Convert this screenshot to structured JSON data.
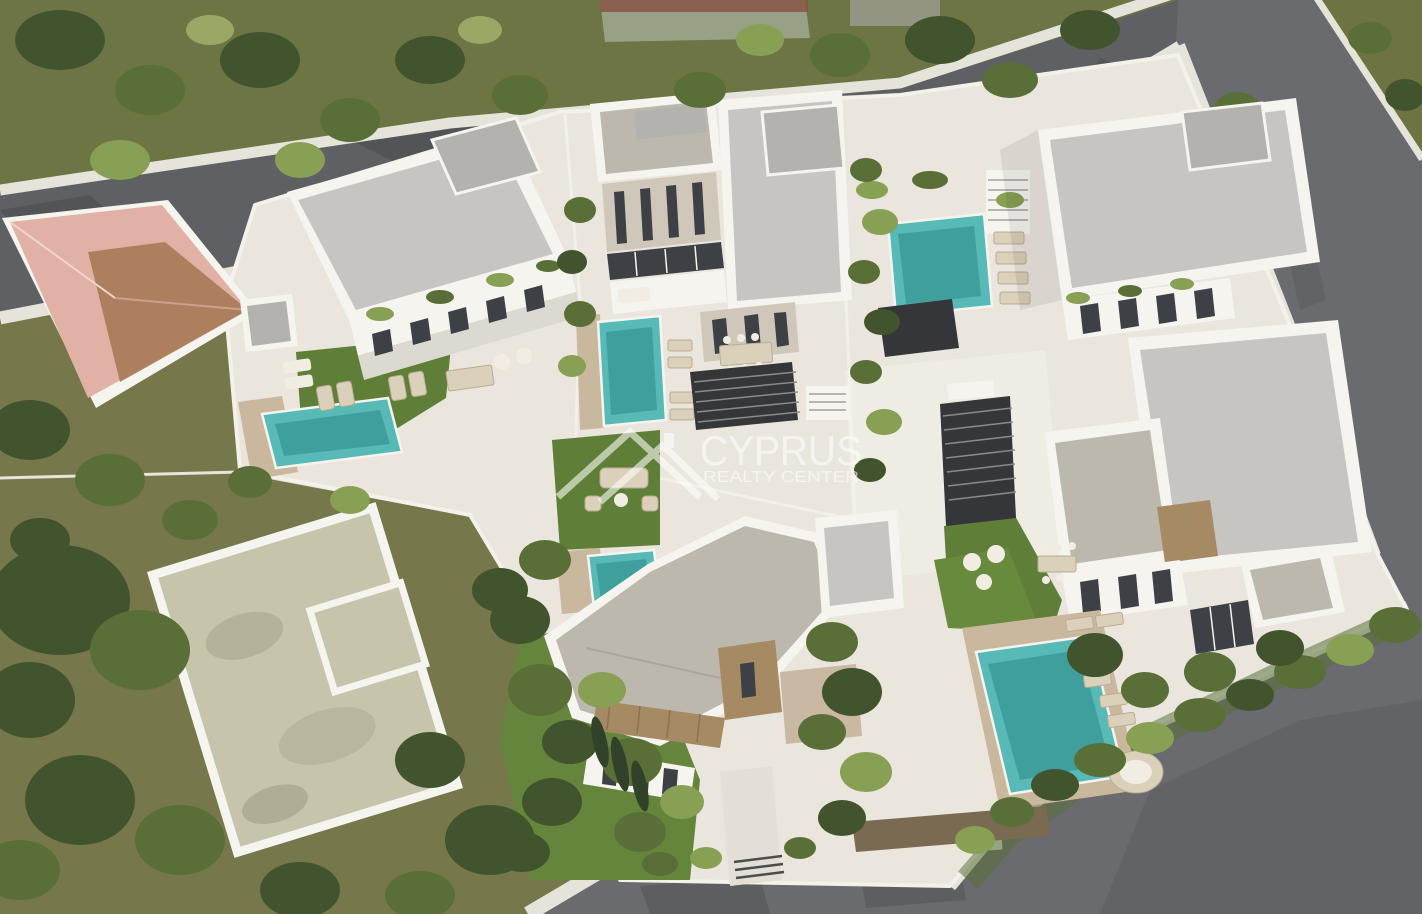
{
  "meta": {
    "title": "Aerial 3D architectural rendering of a modern villa development",
    "render_type": "bird's-eye masterplan visualization",
    "width_px": 1422,
    "height_px": 914
  },
  "watermark": {
    "line1": "CYPRUS",
    "line2": "REALTY CENTER",
    "logo": "double-roofline-house-icon",
    "color": "#ffffff"
  },
  "scene": {
    "villas_count": 6,
    "pools_count": 5,
    "existing_house": "pink tiled hip-roof house on the left",
    "walled_plot": "empty white-walled plot at bottom left",
    "roads": [
      "diagonal road top-left",
      "perimeter road right side",
      "bottom road with curved corner"
    ]
  },
  "colors": {
    "wild_grass": "#76774a",
    "grass_topleft": "#6d7544",
    "lawn": "#5f7e37",
    "asphalt": "#5e6064",
    "asphalt_light": "#696b6e",
    "sidewalk": "#e6e3da",
    "ground": "#eae6de",
    "terrace_bright": "#efece4",
    "wall_white": "#f6f4ef",
    "roof_gray": "#c6c5c1",
    "roof_warm": "#bdb8ae",
    "window": "#3d4045",
    "wood": "#a58a64",
    "deck": "#c9b89e",
    "pool": "#57bab6",
    "pool_deep": "#3f9f9d",
    "pergola": "#35363a",
    "roof_pink": "#e0b1a4",
    "roof_brown": "#a87a56",
    "sand": "#c6c4ab",
    "tree_dark": "#42542e",
    "tree_mid": "#5a6f38",
    "tree_light": "#87a053"
  }
}
